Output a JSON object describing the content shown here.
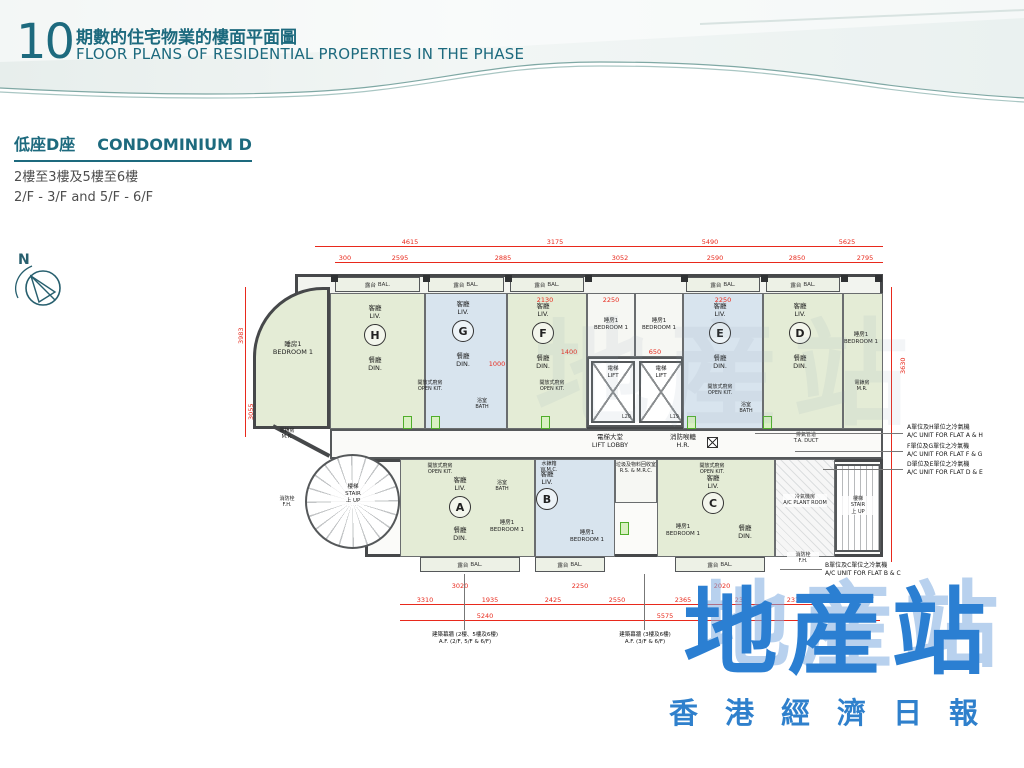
{
  "header": {
    "page_number": "10",
    "title_zh": "期數的住宅物業的樓面平面圖",
    "title_en": "FLOOR PLANS OF RESIDENTIAL PROPERTIES IN THE PHASE"
  },
  "section": {
    "block_zh": "低座D座",
    "block_en": "CONDOMINIUM D",
    "floors_zh": "2樓至3樓及5樓至6樓",
    "floors_en": "2/F - 3/F and 5/F - 6/F"
  },
  "compass": {
    "north": "N"
  },
  "plan": {
    "units": [
      {
        "letter": "H"
      },
      {
        "letter": "G"
      },
      {
        "letter": "F"
      },
      {
        "letter": "E"
      },
      {
        "letter": "D"
      },
      {
        "letter": "A"
      },
      {
        "letter": "B"
      },
      {
        "letter": "C"
      }
    ],
    "lifts": {
      "left": "L20",
      "right": "L19"
    },
    "labels": {
      "bal": {
        "zh": "露台",
        "en": "BAL."
      },
      "liv": {
        "zh": "客廳",
        "en": "LIV."
      },
      "din": {
        "zh": "餐廳",
        "en": "DIN."
      },
      "bed1": {
        "zh": "睡房1",
        "en": "BEDROOM 1"
      },
      "openkit": {
        "zh": "開放式廚房",
        "en": "OPEN KIT."
      },
      "bath": {
        "zh": "浴室",
        "en": "BATH"
      },
      "lift": {
        "zh": "電梯",
        "en": "LIFT"
      },
      "lobby": {
        "zh": "電梯大堂",
        "en": "LIFT LOBBY"
      },
      "hr": {
        "zh": "消防喉轆",
        "en": "H.R."
      },
      "stair": {
        "zh": "樓梯",
        "en": "STAIR"
      },
      "up": {
        "zh": "上 UP",
        "en": ""
      },
      "acplant": {
        "zh": "冷氣機房",
        "en": "A/C PLANT ROOM"
      },
      "meter": {
        "zh": "電錶房",
        "en": "M.R."
      },
      "fh": {
        "zh": "消防栓",
        "en": "F.H."
      },
      "wmc": {
        "zh": "水錶箱",
        "en": "W.M.C."
      },
      "refuse": {
        "zh": "垃圾及物料回收室",
        "en": "R.S. & M.R.C."
      },
      "taduct": {
        "zh": "排氣管道",
        "en": "T.A. DUCT"
      }
    },
    "ac_notes": [
      {
        "zh": "A單位及H單位之冷氣機",
        "en": "A/C UNIT FOR FLAT A & H"
      },
      {
        "zh": "F單位及G單位之冷氣機",
        "en": "A/C UNIT FOR FLAT F & G"
      },
      {
        "zh": "D單位及E單位之冷氣機",
        "en": "A/C UNIT FOR FLAT D & E"
      },
      {
        "zh": "B單位及C單位之冷氣機",
        "en": "A/C UNIT FOR FLAT B & C"
      }
    ],
    "af_notes": [
      {
        "zh": "建築幕牆 (2樓、5樓及6樓)",
        "en": "A.F. (2/F, 5/F & 6/F)"
      },
      {
        "zh": "建築幕牆 (3樓及6樓)",
        "en": "A.F. (3/F & 6/F)"
      }
    ],
    "dims": {
      "top1": [
        "4615",
        "3175",
        "5490",
        "5625"
      ],
      "top2": [
        "300",
        "2595",
        "2885",
        "3052",
        "2590",
        "2850",
        "2795"
      ],
      "bottom1": [
        "3310",
        "1935",
        "2425",
        "2550",
        "2365",
        "2350",
        "2310"
      ],
      "bottom2": [
        "5240",
        "5575",
        "5110"
      ],
      "left": [
        "3983",
        "3055"
      ],
      "right": [
        "3630"
      ],
      "inner": [
        "2130",
        "2250",
        "2250",
        "1400",
        "1000",
        "650",
        "3020",
        "2250",
        "2020"
      ]
    }
  },
  "logo": {
    "main": "地産站",
    "sub": "香港經濟日報"
  },
  "colors": {
    "teal": "#1d6a7e",
    "dim_red": "#e8291c",
    "unit_green": "#e4ecd6",
    "unit_blue": "#d8e4ee",
    "wall": "#46484a",
    "logo_blue": "#2b7fd2"
  }
}
